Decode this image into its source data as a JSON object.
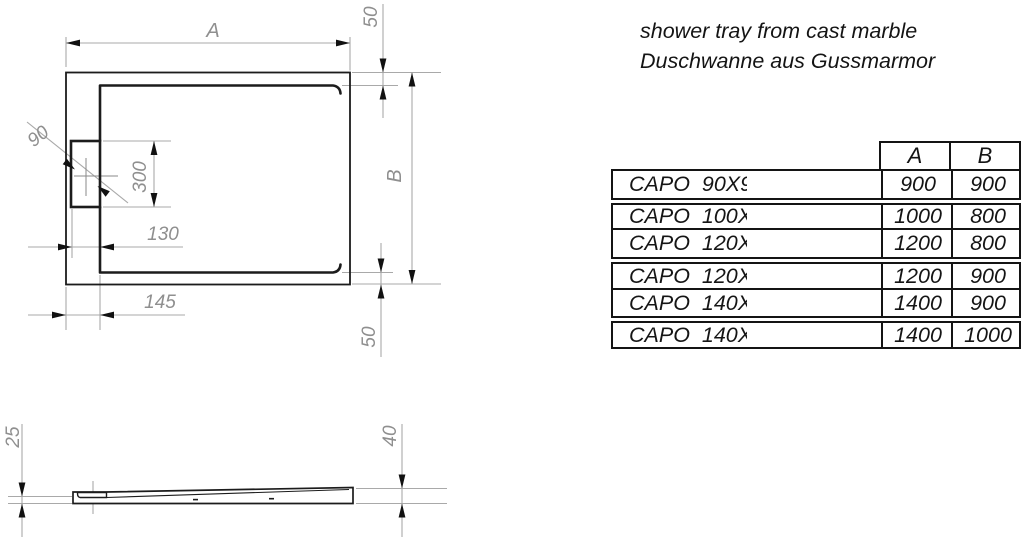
{
  "title": {
    "line1": "shower tray from cast marble",
    "line2": "Duschwanne aus Gussmarmor"
  },
  "top_view": {
    "dim_width": "A",
    "dim_depth": "B",
    "dim_top_edge": "50",
    "dim_bottom_edge": "50",
    "dim_drain_diameter": "90",
    "dim_drain_zone_length": "300",
    "dim_drain_offset": "130",
    "dim_flange_width": "145"
  },
  "side_view": {
    "dim_front_height": "25",
    "dim_rear_height": "40"
  },
  "size_table": {
    "col_a": "A",
    "col_b": "B",
    "rows": [
      {
        "name": "CAPO  90X90",
        "a": "900",
        "b": "900"
      },
      {
        "name": "CAPO  100X80",
        "a": "1000",
        "b": "800"
      },
      {
        "name": "CAPO  120X80",
        "a": "1200",
        "b": "800"
      },
      {
        "name": "CAPO  120X90",
        "a": "1200",
        "b": "900"
      },
      {
        "name": "CAPO  140X90",
        "a": "1400",
        "b": "900"
      },
      {
        "name": "CAPO  140X100",
        "a": "1400",
        "b": "1000"
      }
    ]
  },
  "colors": {
    "background": "#ffffff",
    "object_line": "#1c1c1c",
    "dimension_line": "#a9a9a9",
    "dimension_text": "#8f8f8f",
    "arrowhead": "#111111",
    "table_border": "#141414"
  }
}
